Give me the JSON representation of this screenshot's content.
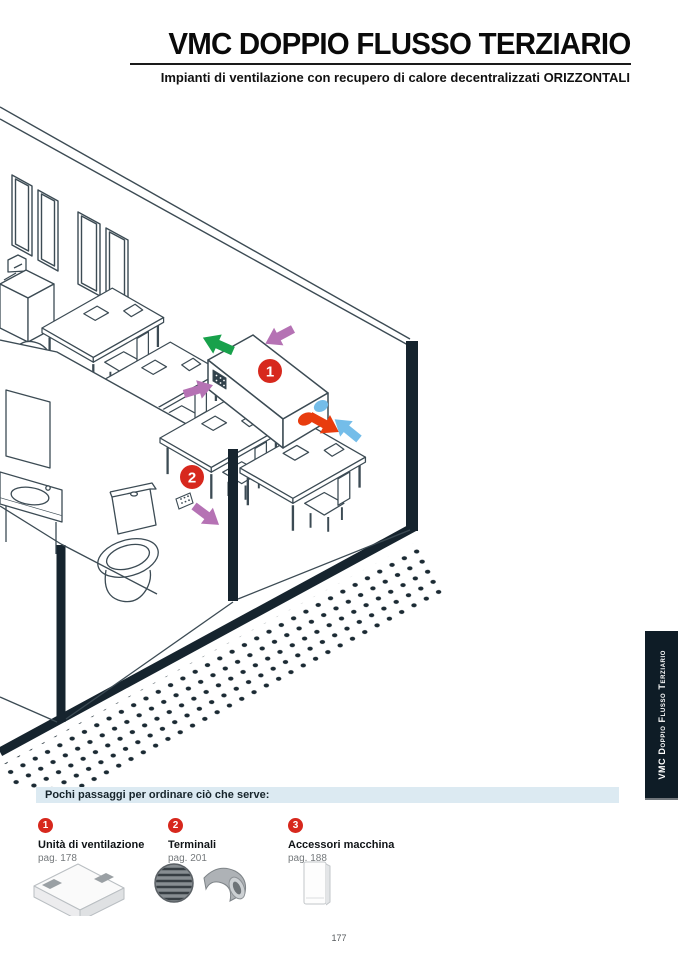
{
  "header": {
    "title": "VMC DOPPIO FLUSSO TERZIARIO",
    "subtitle": "Impianti di ventilazione con recupero di calore decentralizzati ORIZZONTALI"
  },
  "side_tab": {
    "label": "VMC Doppio Flusso Terziario"
  },
  "diagram": {
    "marker_1": "1",
    "marker_2": "2",
    "colors": {
      "extract_green": "#18a14b",
      "transfer_purple": "#b572b4",
      "exhaust_orange": "#e83c0e",
      "intake_blue": "#74bde9",
      "marker_red": "#d7281d"
    }
  },
  "order_bar": {
    "heading": "Pochi passaggi per ordinare ciò che serve:"
  },
  "steps": [
    {
      "number": "1",
      "name": "Unità di ventilazione",
      "page_ref": "pag. 178"
    },
    {
      "number": "2",
      "name": "Terminali",
      "page_ref": "pag. 201"
    },
    {
      "number": "3",
      "name": "Accessori macchina",
      "page_ref": "pag. 188"
    }
  ],
  "footer": {
    "page_number": "177"
  }
}
